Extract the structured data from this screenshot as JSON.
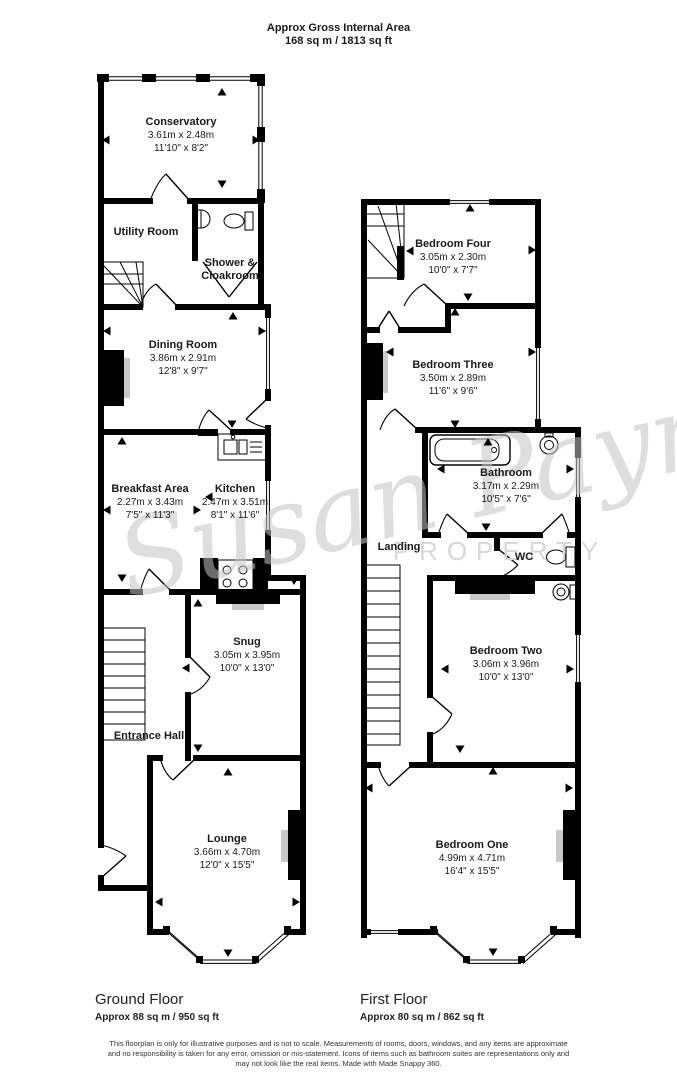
{
  "header": {
    "title": "Approx Gross Internal Area",
    "subtitle": "168 sq m / 1813 sq ft"
  },
  "watermark": {
    "script": "Susan Payne",
    "caption": "PROPERTY"
  },
  "floors": {
    "ground": {
      "label": "Ground Floor",
      "area": "Approx 88 sq m / 950 sq ft",
      "rooms": {
        "conservatory": {
          "name": "Conservatory",
          "metric": "3.61m x 2.48m",
          "imperial": "11'10\" x 8'2\""
        },
        "utility": {
          "name": "Utility Room"
        },
        "shower": {
          "name": "Shower &",
          "name2": "Cloakroom"
        },
        "dining": {
          "name": "Dining Room",
          "metric": "3.86m x 2.91m",
          "imperial": "12'8\" x 9'7\""
        },
        "breakfast": {
          "name": "Breakfast Area",
          "metric": "2.27m x 3.43m",
          "imperial": "7'5\" x 11'3\""
        },
        "kitchen": {
          "name": "Kitchen",
          "metric": "2.47m x 3.51m",
          "imperial": "8'1\" x 11'6\""
        },
        "snug": {
          "name": "Snug",
          "metric": "3.05m x 3.95m",
          "imperial": "10'0\" x 13'0\""
        },
        "entrance": {
          "name": "Entrance Hall"
        },
        "lounge": {
          "name": "Lounge",
          "metric": "3.66m x 4.70m",
          "imperial": "12'0\" x 15'5\""
        }
      }
    },
    "first": {
      "label": "First Floor",
      "area": "Approx 80 sq m / 862 sq ft",
      "rooms": {
        "bedroom4": {
          "name": "Bedroom Four",
          "metric": "3.05m x 2.30m",
          "imperial": "10'0\" x 7'7\""
        },
        "bedroom3": {
          "name": "Bedroom Three",
          "metric": "3.50m x 2.89m",
          "imperial": "11'6\" x 9'6\""
        },
        "bathroom": {
          "name": "Bathroom",
          "metric": "3.17m x 2.29m",
          "imperial": "10'5\" x 7'6\""
        },
        "landing": {
          "name": "Landing"
        },
        "wc": {
          "name": "WC"
        },
        "bedroom2": {
          "name": "Bedroom Two",
          "metric": "3.06m x 3.96m",
          "imperial": "10'0\" x 13'0\""
        },
        "bedroom1": {
          "name": "Bedroom One",
          "metric": "4.99m x 4.71m",
          "imperial": "16'4\" x 15'5\""
        }
      }
    }
  },
  "footer": {
    "disclaimer_line1": "This floorplan is only for illustrative purposes and is not to scale. Measurements of rooms, doors, windows, and any items are approximate",
    "disclaimer_line2": "and no responsibility is taken for any error, omission or mis-statement. Icons of items such as bathroom suites are representations only and",
    "disclaimer_line3": "may not look like the real items. Made with Made Snappy 360."
  }
}
